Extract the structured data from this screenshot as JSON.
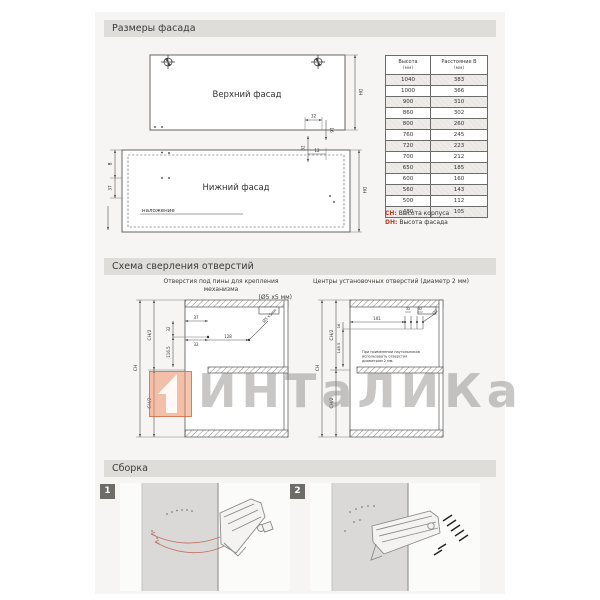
{
  "sections": {
    "facade_title": "Размеры фасада",
    "drilling_title": "Схема сверления отверстий",
    "assembly_title": "Сборка"
  },
  "facade": {
    "upper_label": "Верхний фасад",
    "lower_label": "Нижний фасад",
    "overlay_label": "наложение",
    "dims": {
      "dh": "DH",
      "b": "B",
      "d37": "37",
      "d32": "32",
      "d16": "16",
      "d12": "12"
    },
    "table": {
      "col1": "Высота",
      "col1_unit": "(мм)",
      "col2": "Расстояние B",
      "col2_unit": "(мм)",
      "rows": [
        {
          "h": "1040",
          "b": "383"
        },
        {
          "h": "1000",
          "b": "366"
        },
        {
          "h": "900",
          "b": "310"
        },
        {
          "h": "860",
          "b": "302"
        },
        {
          "h": "800",
          "b": "260"
        },
        {
          "h": "760",
          "b": "245"
        },
        {
          "h": "720",
          "b": "223"
        },
        {
          "h": "700",
          "b": "212"
        },
        {
          "h": "650",
          "b": "185"
        },
        {
          "h": "600",
          "b": "160"
        },
        {
          "h": "560",
          "b": "143"
        },
        {
          "h": "500",
          "b": "112"
        },
        {
          "h": "480",
          "b": "105"
        }
      ]
    },
    "legend": {
      "key1": "CH:",
      "text1": "Высота корпуса",
      "key2": "DH:",
      "text2": "Высота фасада"
    }
  },
  "drilling": {
    "left_caption": "Отверстия под пины для крепления механизма",
    "left_caption2": "(Ø5 х5 мм)",
    "right_caption": "Центры установочных отверстий (диаметр 2 мм)",
    "ch": "CH",
    "ch2": "CH/2",
    "left_dims": {
      "top": "37",
      "v1": "32",
      "v2": "116.5",
      "h1": "32",
      "h2": "128",
      "leader": "Ø5 х5мм"
    },
    "right_dims": {
      "h": "101",
      "s1": "32",
      "s2": "32",
      "v1": "16",
      "v2": "148.5",
      "leader": "Ø2"
    },
    "note1": "При применении наугольников",
    "note2": "использовать отверстия",
    "note3": "диаметром 2 мм."
  },
  "assembly": {
    "step1": "1",
    "step2": "2"
  },
  "watermark": {
    "text": "ИНТаЛИКа",
    "logo": "1"
  }
}
